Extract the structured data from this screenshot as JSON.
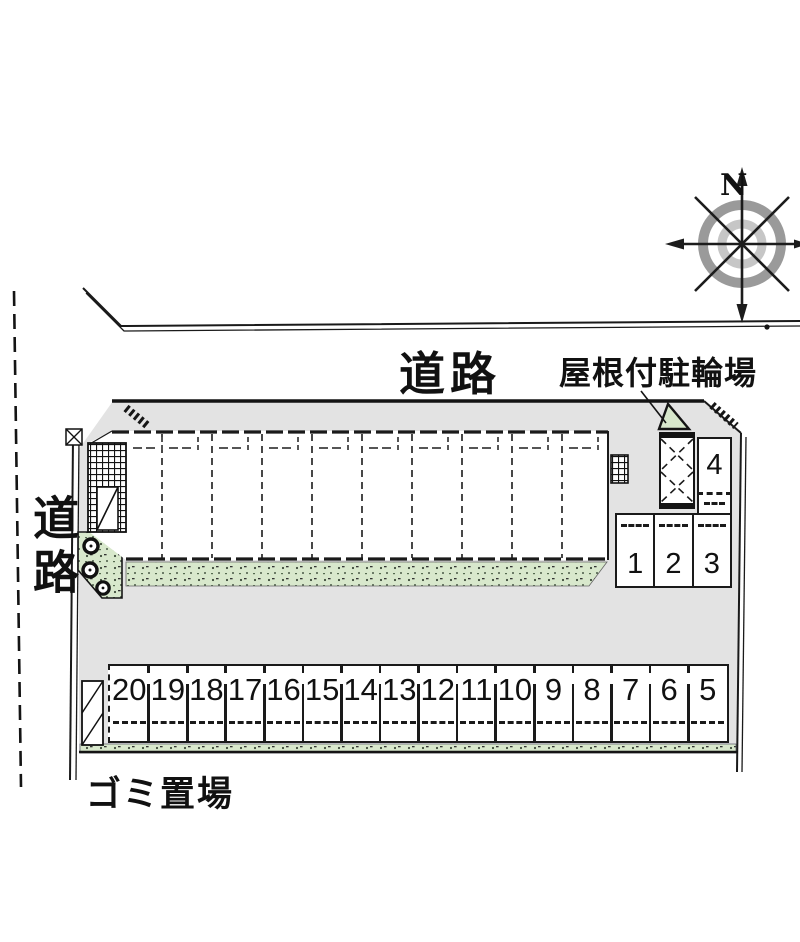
{
  "labels": {
    "road_top": "道路",
    "road_left": "道路",
    "bike_shed": "屋根付駐輪場",
    "garbage": "ゴミ置場",
    "compass_north": "N"
  },
  "parking": {
    "row_bottom": [
      "20",
      "19",
      "18",
      "17",
      "16",
      "15",
      "14",
      "13",
      "12",
      "11",
      "10",
      "9",
      "8",
      "7",
      "6",
      "5"
    ],
    "row_right": [
      "1",
      "2",
      "3"
    ],
    "space_single": "4"
  },
  "building": {
    "unit_count": 10
  },
  "colors": {
    "line": "#1a1a1a",
    "site_fill": "#e3e3e3",
    "green_fill": "#d8e8cc",
    "compass_outer": "#9a9a9a",
    "compass_inner": "#c6c6c6"
  }
}
